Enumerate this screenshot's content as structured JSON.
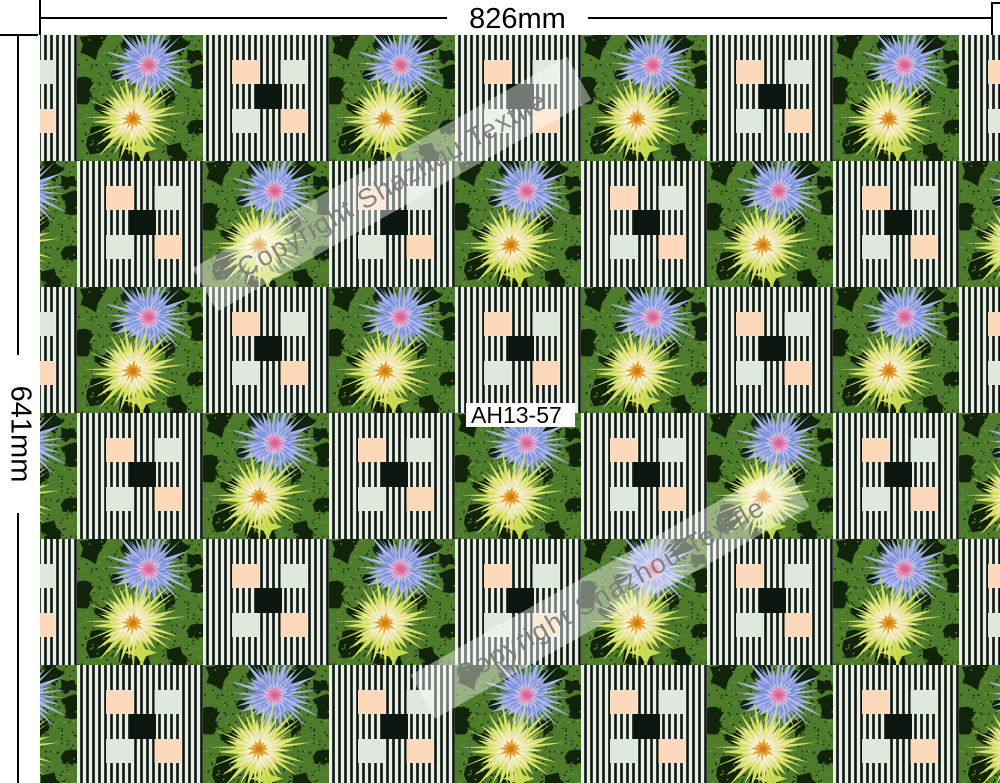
{
  "dimensions": {
    "width_label": "826mm",
    "height_label": "641mm"
  },
  "swatch_label": "AH13-57",
  "watermark": {
    "text": "Copyright Shazhou Textile"
  },
  "pattern": {
    "description": "checkerboard of flower tiles and pinstripe tiles",
    "tile_types": [
      "flower",
      "stripe"
    ],
    "colors": {
      "leaf_green": "#4e7b2b",
      "dark_green": "#0e2007",
      "light_green": "#6d9c3c",
      "blue_outer": "#a9b4ea",
      "blue_mid": "#7e91d9",
      "blue_light": "#b9c2f0",
      "pink": "#e78bb0",
      "pink_dark": "#d4689c",
      "yellow_outer": "#d7e062",
      "cream": "#ece7ad",
      "cream_light": "#f5f0cb",
      "orange": "#e89c2c",
      "orange_dark": "#c97f17",
      "stem": "#b8cf45",
      "leaf": "#c6d94e",
      "stripe_bg": "#e9efe6",
      "stripe": "#0d150f",
      "peach": "#fcd9bb",
      "pale": "#dee8dd",
      "square_black": "#0d1712",
      "watermark_text": "#7a7a7a",
      "dimension_line": "#000000"
    }
  }
}
